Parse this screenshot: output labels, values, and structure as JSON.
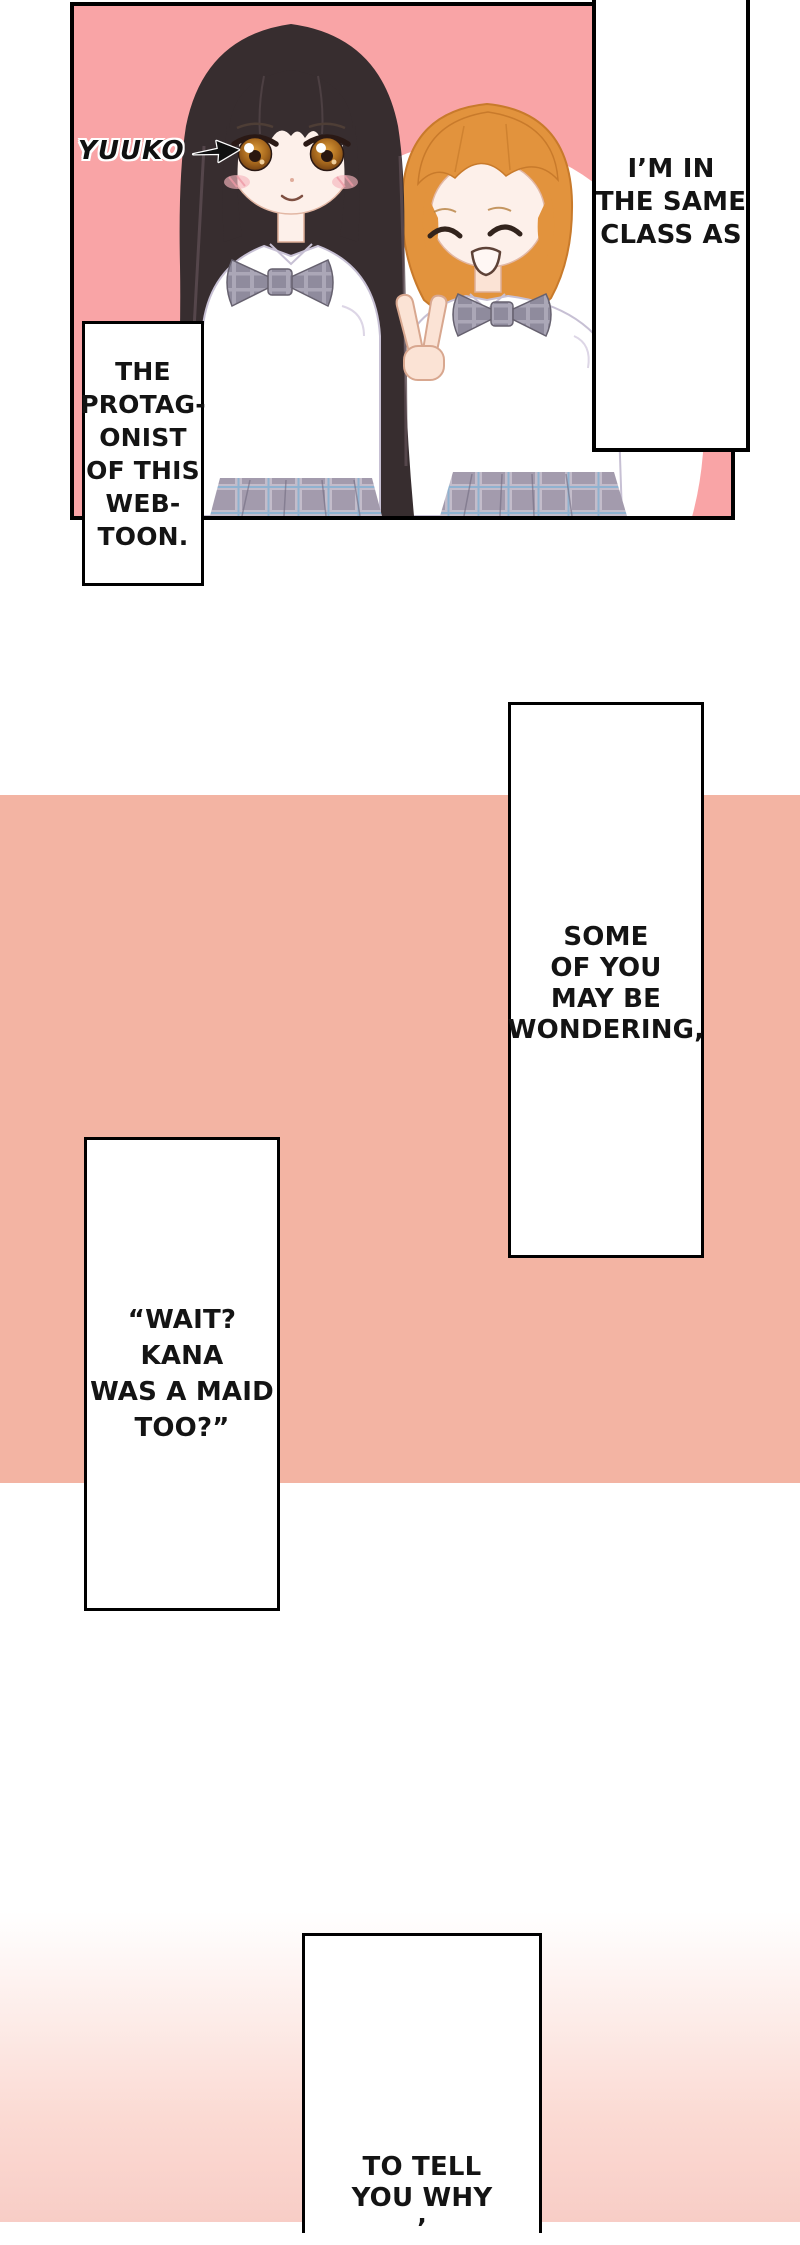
{
  "page": {
    "width": 800,
    "height": 2222
  },
  "colors": {
    "panel_pink": "#F9A4A6",
    "band_salmon": "#F3B4A3",
    "gradient_pink": "#F8CDC6",
    "outline_black": "#000000",
    "text_ink": "#141414",
    "hair_dark_brown": "#372D2F",
    "hair_orange": "#E2933D",
    "skin": "#FDF0EA",
    "uniform_gray": "#A39BAD"
  },
  "top_panel": {
    "character_label": "YUUKO",
    "arrow_icon": "right-arrow",
    "illustration_alt": "Two schoolgirls in white shirts with gray plaid bows: long dark-haired Yuuko smiling, and a short orange-haired classmate with closed happy eyes giving a peace sign"
  },
  "speech": {
    "class_bubble": {
      "lines": [
        "I’M IN",
        "THE SAME",
        "CLASS AS"
      ]
    },
    "protagonist_box": {
      "lines": [
        "THE",
        "PROTAG-",
        "ONIST",
        "OF THIS",
        "WEB-",
        "TOON."
      ]
    },
    "wondering_box": {
      "lines": [
        "SOME",
        "OF YOU",
        "MAY BE",
        "WONDERING,"
      ]
    },
    "wait_box": {
      "lines": [
        "“WAIT?",
        "KANA",
        "WAS A MAID",
        "TOO?”"
      ]
    },
    "tell_box": {
      "lines": [
        "TO TELL",
        "YOU WHY",
        "’"
      ]
    }
  }
}
